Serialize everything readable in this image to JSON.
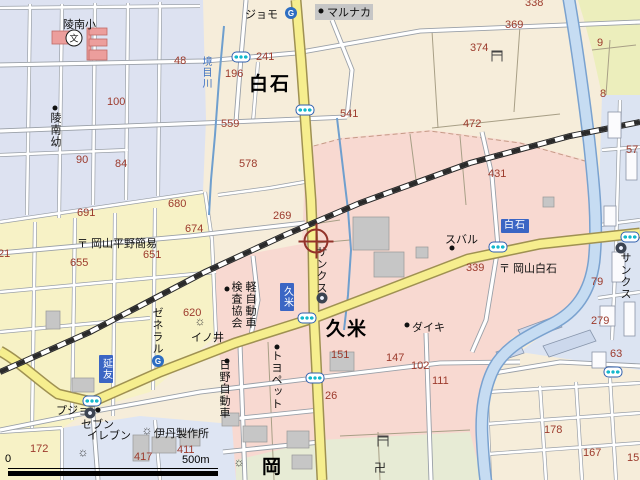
{
  "map": {
    "scale": {
      "start": "0",
      "end": "500m"
    },
    "icon_glyphs": {
      "gas": "G",
      "school": "文",
      "temple": "卍",
      "factory": "☼"
    },
    "colors": {
      "urban_pink": "#f8d9d1",
      "residential_lavender": "#dde2f1",
      "field_cream": "#f6edda",
      "district_yellow": "#f7f2c6",
      "district_blue": "#dee5f3",
      "green_fields": "#e7ebd5",
      "road_yellow": "#f6ee8e",
      "river_blue": "#c6dcf2",
      "number_red": "#9c3a2c",
      "bus_stop_blue": "#3b66c4",
      "railway_black": "#2a2a2a",
      "cursor_red": "#93332a"
    },
    "labels": [
      {
        "text": "48",
        "x": 174,
        "y": 55,
        "type": "num"
      },
      {
        "text": "100",
        "x": 107,
        "y": 96,
        "type": "num"
      },
      {
        "text": "90",
        "x": 76,
        "y": 154,
        "type": "num"
      },
      {
        "text": "84",
        "x": 115,
        "y": 158,
        "type": "num"
      },
      {
        "text": "241",
        "x": 256,
        "y": 51,
        "type": "num"
      },
      {
        "text": "196",
        "x": 225,
        "y": 68,
        "type": "num"
      },
      {
        "text": "559",
        "x": 221,
        "y": 118,
        "type": "num"
      },
      {
        "text": "541",
        "x": 340,
        "y": 108,
        "type": "num"
      },
      {
        "text": "338",
        "x": 525,
        "y": -3,
        "type": "num"
      },
      {
        "text": "369",
        "x": 505,
        "y": 19,
        "type": "num"
      },
      {
        "text": "374",
        "x": 470,
        "y": 42,
        "type": "num"
      },
      {
        "text": "9",
        "x": 597,
        "y": 37,
        "type": "num"
      },
      {
        "text": "8",
        "x": 600,
        "y": 88,
        "type": "num"
      },
      {
        "text": "472",
        "x": 463,
        "y": 118,
        "type": "num"
      },
      {
        "text": "57",
        "x": 626,
        "y": 144,
        "type": "num"
      },
      {
        "text": "691",
        "x": 77,
        "y": 207,
        "type": "num"
      },
      {
        "text": "680",
        "x": 168,
        "y": 198,
        "type": "num"
      },
      {
        "text": "674",
        "x": 185,
        "y": 223,
        "type": "num"
      },
      {
        "text": "651",
        "x": 143,
        "y": 249,
        "type": "num"
      },
      {
        "text": "655",
        "x": 70,
        "y": 257,
        "type": "num"
      },
      {
        "text": "21",
        "x": -2,
        "y": 248,
        "type": "num"
      },
      {
        "text": "620",
        "x": 183,
        "y": 307,
        "type": "num"
      },
      {
        "text": "578",
        "x": 239,
        "y": 158,
        "type": "num"
      },
      {
        "text": "269",
        "x": 273,
        "y": 210,
        "type": "num"
      },
      {
        "text": "431",
        "x": 488,
        "y": 168,
        "type": "num"
      },
      {
        "text": "339",
        "x": 466,
        "y": 262,
        "type": "num"
      },
      {
        "text": "79",
        "x": 591,
        "y": 276,
        "type": "num"
      },
      {
        "text": "279",
        "x": 591,
        "y": 315,
        "type": "num"
      },
      {
        "text": "63",
        "x": 610,
        "y": 348,
        "type": "num"
      },
      {
        "text": "151",
        "x": 331,
        "y": 349,
        "type": "num"
      },
      {
        "text": "147",
        "x": 386,
        "y": 352,
        "type": "num"
      },
      {
        "text": "102",
        "x": 411,
        "y": 360,
        "type": "num"
      },
      {
        "text": "26",
        "x": 325,
        "y": 390,
        "type": "num"
      },
      {
        "text": "111",
        "x": 432,
        "y": 375,
        "type": "num"
      },
      {
        "text": "178",
        "x": 544,
        "y": 424,
        "type": "num"
      },
      {
        "text": "167",
        "x": 583,
        "y": 447,
        "type": "num"
      },
      {
        "text": "15",
        "x": 627,
        "y": 452,
        "type": "num"
      },
      {
        "text": "172",
        "x": 30,
        "y": 443,
        "type": "num"
      },
      {
        "text": "417",
        "x": 134,
        "y": 451,
        "type": "num"
      },
      {
        "text": "411",
        "x": 177,
        "y": 444,
        "type": "num"
      },
      {
        "text": "陵南小",
        "x": 63,
        "y": 16,
        "type": "poi"
      },
      {
        "text": "ジョモ",
        "x": 245,
        "y": 6,
        "type": "poi"
      },
      {
        "text": "マルナカ",
        "x": 327,
        "y": 4,
        "type": "poi-hl"
      },
      {
        "text": "スバル",
        "x": 445,
        "y": 231,
        "type": "poi"
      },
      {
        "text": "ダイキ",
        "x": 412,
        "y": 319,
        "type": "poi"
      },
      {
        "text": "〒 岡山平野簡易",
        "x": 77,
        "y": 235,
        "type": "poi"
      },
      {
        "text": "〒 岡山白石",
        "x": 499,
        "y": 260,
        "type": "poi"
      },
      {
        "text": "プジョー",
        "x": 56,
        "y": 402,
        "type": "poi"
      },
      {
        "text": "セブン",
        "x": 81,
        "y": 416,
        "type": "poi"
      },
      {
        "text": "イレブン",
        "x": 87,
        "y": 427,
        "type": "poi"
      },
      {
        "text": "伊丹製作所",
        "x": 154,
        "y": 425,
        "type": "poi"
      },
      {
        "text": "イノ井",
        "x": 191,
        "y": 329,
        "type": "poi"
      },
      {
        "text": "陵南幼",
        "x": 47,
        "y": 112,
        "type": "poi-v"
      },
      {
        "text": "サンクス",
        "x": 313,
        "y": 246,
        "type": "poi-v"
      },
      {
        "text": "サンクス",
        "x": 617,
        "y": 252,
        "type": "poi-v"
      },
      {
        "text": "ゼネラル",
        "x": 149,
        "y": 307,
        "type": "poi-v"
      },
      {
        "text": "トヨペット",
        "x": 268,
        "y": 350,
        "type": "poi-v"
      },
      {
        "text": "日野自動車",
        "x": 216,
        "y": 359,
        "type": "poi-v"
      },
      {
        "text": "軽自動車",
        "x": 242,
        "y": 281,
        "type": "poi-v"
      },
      {
        "text": "検査協会",
        "x": 228,
        "y": 281,
        "type": "poi-v"
      },
      {
        "text": "境目川",
        "x": 198,
        "y": 56,
        "type": "water-v"
      },
      {
        "text": "白石",
        "x": 249,
        "y": 69,
        "type": "area"
      },
      {
        "text": "久米",
        "x": 326,
        "y": 314,
        "type": "area"
      },
      {
        "text": "岡",
        "x": 262,
        "y": 452,
        "type": "area"
      }
    ],
    "bus_stops": [
      {
        "text": "延友",
        "x": 99,
        "y": 355,
        "vertical": true
      },
      {
        "text": "久米",
        "x": 280,
        "y": 283,
        "vertical": true
      },
      {
        "text": "白石",
        "x": 501,
        "y": 219,
        "vertical": false
      }
    ],
    "icons": [
      {
        "kind": "signal",
        "x": 241,
        "y": 57
      },
      {
        "kind": "signal",
        "x": 305,
        "y": 110
      },
      {
        "kind": "signal",
        "x": 307,
        "y": 318
      },
      {
        "kind": "signal",
        "x": 315,
        "y": 378
      },
      {
        "kind": "signal",
        "x": 92,
        "y": 401
      },
      {
        "kind": "signal",
        "x": 498,
        "y": 247
      },
      {
        "kind": "signal",
        "x": 630,
        "y": 237
      },
      {
        "kind": "signal",
        "x": 613,
        "y": 372
      },
      {
        "kind": "gas",
        "x": 291,
        "y": 13
      },
      {
        "kind": "gas",
        "x": 158,
        "y": 361
      },
      {
        "kind": "store",
        "x": 322,
        "y": 298
      },
      {
        "kind": "store",
        "x": 621,
        "y": 248
      },
      {
        "kind": "store",
        "x": 90,
        "y": 413
      },
      {
        "kind": "factory",
        "x": 147,
        "y": 430
      },
      {
        "kind": "factory",
        "x": 200,
        "y": 321
      },
      {
        "kind": "factory",
        "x": 83,
        "y": 452
      },
      {
        "kind": "factory",
        "x": 239,
        "y": 462
      },
      {
        "kind": "torii",
        "x": 497,
        "y": 56
      },
      {
        "kind": "torii",
        "x": 383,
        "y": 441
      },
      {
        "kind": "temple",
        "x": 380,
        "y": 467
      },
      {
        "kind": "school",
        "x": 74,
        "y": 38
      },
      {
        "kind": "dot",
        "x": 321,
        "y": 11
      },
      {
        "kind": "dot",
        "x": 55,
        "y": 108
      },
      {
        "kind": "dot",
        "x": 452,
        "y": 248
      },
      {
        "kind": "dot",
        "x": 407,
        "y": 325
      },
      {
        "kind": "dot",
        "x": 227,
        "y": 289
      },
      {
        "kind": "dot",
        "x": 277,
        "y": 347
      },
      {
        "kind": "dot",
        "x": 227,
        "y": 361
      },
      {
        "kind": "dot",
        "x": 98,
        "y": 410
      },
      {
        "kind": "cursor",
        "x": 316,
        "y": 241
      }
    ]
  }
}
